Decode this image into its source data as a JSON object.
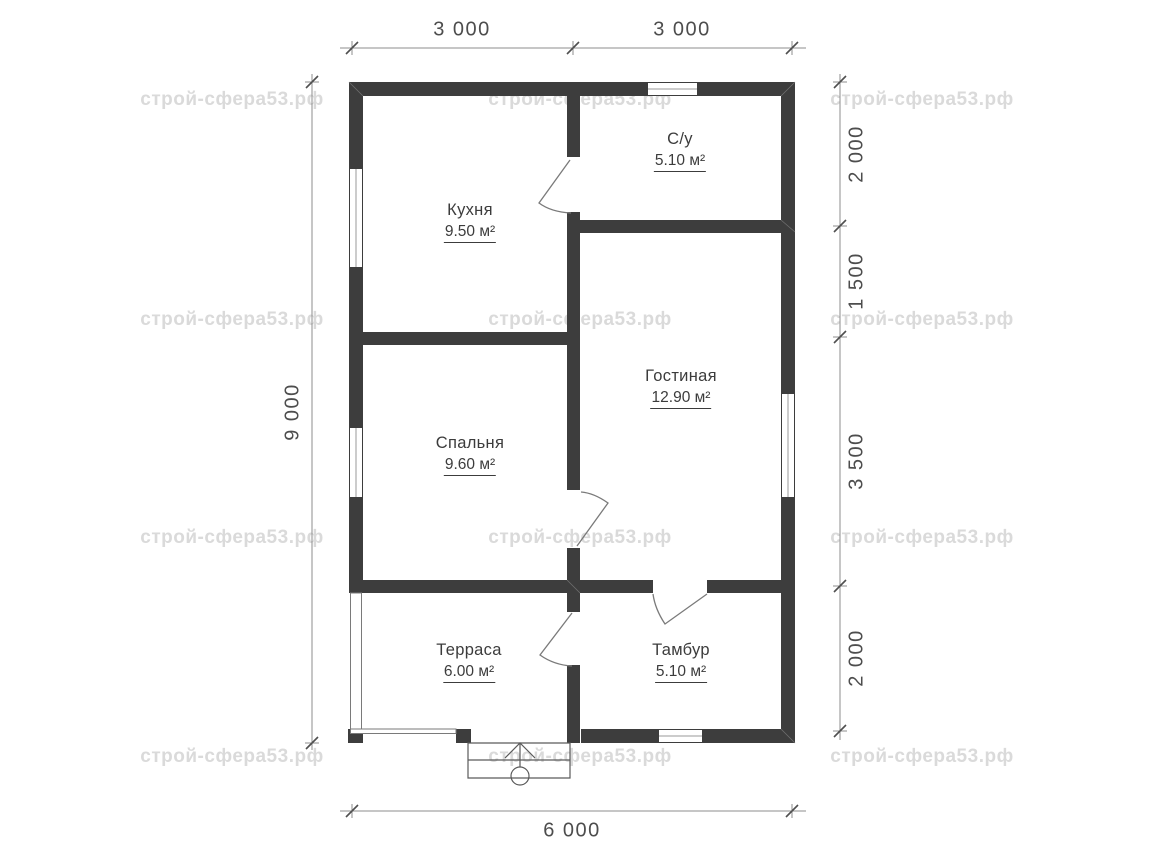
{
  "watermark": {
    "text": "строй-сфера53.рф"
  },
  "rooms": [
    {
      "name": "Кухня",
      "area": "9.50 м²"
    },
    {
      "name": "С/у",
      "area": "5.10 м²"
    },
    {
      "name": "Гостиная",
      "area": "12.90 м²"
    },
    {
      "name": "Спальня",
      "area": "9.60 м²"
    },
    {
      "name": "Терраса",
      "area": "6.00 м²"
    },
    {
      "name": "Тамбур",
      "area": "5.10 м²"
    }
  ],
  "dimensions": {
    "top": [
      "3 000",
      "3 000"
    ],
    "right": [
      "2 000",
      "1 500",
      "3 500",
      "2 000"
    ],
    "left": [
      "9 000"
    ],
    "bottom": [
      "6 000"
    ]
  }
}
